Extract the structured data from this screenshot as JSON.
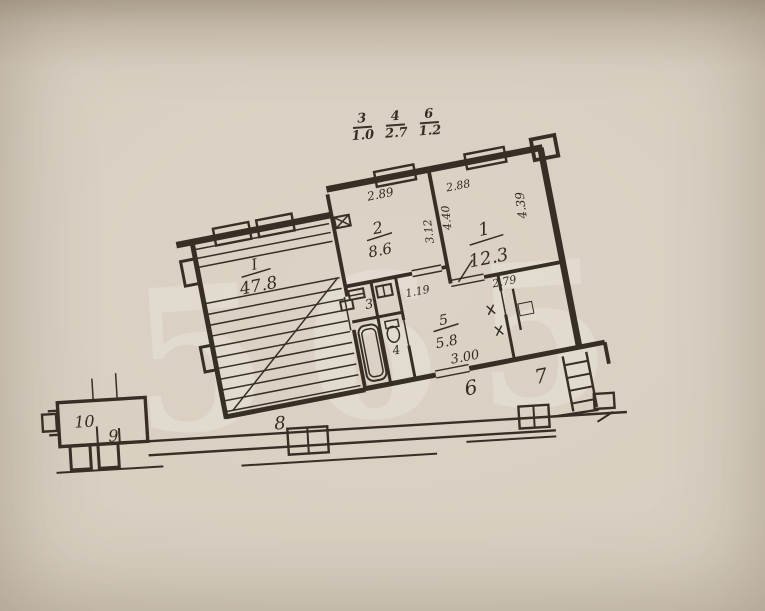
{
  "schedule": {
    "items": [
      {
        "num": "3",
        "den": "1.0"
      },
      {
        "num": "4",
        "den": "2.7"
      },
      {
        "num": "6",
        "den": "1.2"
      }
    ]
  },
  "stairwell": {
    "number": "I",
    "area": "47.8"
  },
  "rooms": {
    "room1": {
      "number": "1",
      "area": "12.3",
      "dim_top": "2.88",
      "dim_left": "4.40",
      "dim_right": "4.39",
      "dim_bottom": "2.79"
    },
    "room2": {
      "number": "2",
      "area": "8.6",
      "dim_top": "2.89",
      "dim_right": "3.12"
    },
    "room3": {
      "number": "3"
    },
    "room4": {
      "number": "4"
    },
    "room5": {
      "number": "5",
      "area": "5.8",
      "dim_top": "1.19",
      "dim_bottom": "3.00"
    }
  },
  "marks": {
    "m6": "6",
    "m7": "7",
    "m8": "8",
    "m9": "9",
    "m10": "10"
  },
  "watermark": "565",
  "colors": {
    "paper": "#d8cfc1",
    "ink": "#372f25"
  }
}
